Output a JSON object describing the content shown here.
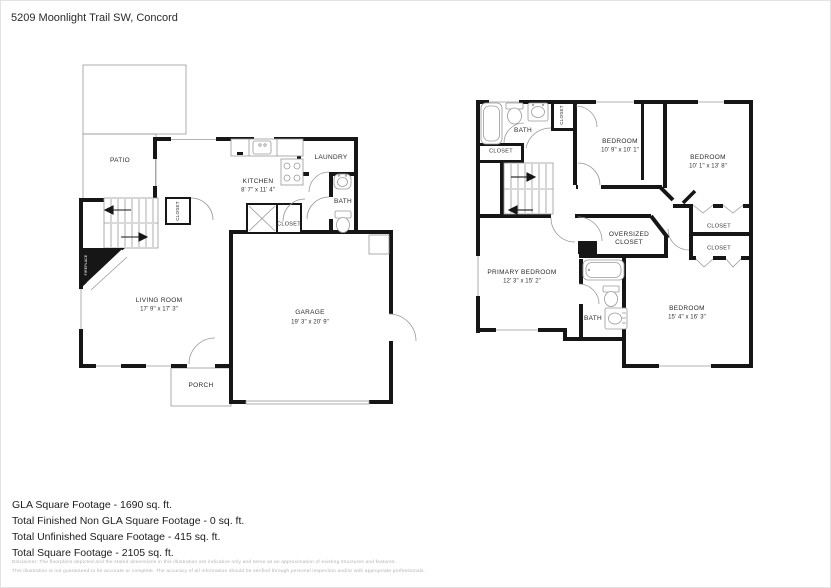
{
  "title": "5209 Moonlight Trail SW, Concord",
  "first_floor": {
    "patio": "PATIO",
    "kitchen": {
      "label": "KITCHEN",
      "dims": "8' 7\" x 11' 4\""
    },
    "laundry": "LAUNDRY",
    "bath": "BATH",
    "stair_closet": "CLOSET",
    "kitchen_closet": "CLOSET",
    "living_room": {
      "label": "LIVING ROOM",
      "dims": "17' 9\" x 17' 3\""
    },
    "garage": {
      "label": "GARAGE",
      "dims": "19' 3\" x 20' 9\""
    },
    "porch": "PORCH",
    "fireplace": "FIREPLACE"
  },
  "second_floor": {
    "bath_upper": "BATH",
    "closet_small": "CLOSET",
    "closet_hall": "CLOSET",
    "bedroom1": {
      "label": "BEDROOM",
      "dims": "10' 9\" x 10' 1\""
    },
    "bedroom2": {
      "label": "BEDROOM",
      "dims": "10' 1\" x 13' 8\""
    },
    "oversized_closet": "OVERSIZED CLOSET",
    "closet_right1": "CLOSET",
    "closet_right2": "CLOSET",
    "primary_bedroom": {
      "label": "PRIMARY BEDROOM",
      "dims": "12' 3\" x 15' 2\""
    },
    "bath_lower": "BATH",
    "bedroom3": {
      "label": "BEDROOM",
      "dims": "15' 4\" x 16' 3\""
    }
  },
  "summary": {
    "gla": "GLA Square Footage - 1690 sq. ft.",
    "non_gla": "Total Finished Non GLA Square Footage - 0 sq. ft.",
    "unfinished": "Total Unfinished Square Footage - 415 sq. ft.",
    "total": "Total Square Footage - 2105 sq. ft."
  },
  "disclaimer": {
    "line1": "Disclaimer: The floorplans depicted and the stated dimensions in this illustration are indicative only and serve as an approximation of existing structures and features.",
    "line2": "This illustration is not guaranteed to be accurate or complete. The accuracy of all information should be verified through personal inspection and/or with appropriate professionals."
  }
}
